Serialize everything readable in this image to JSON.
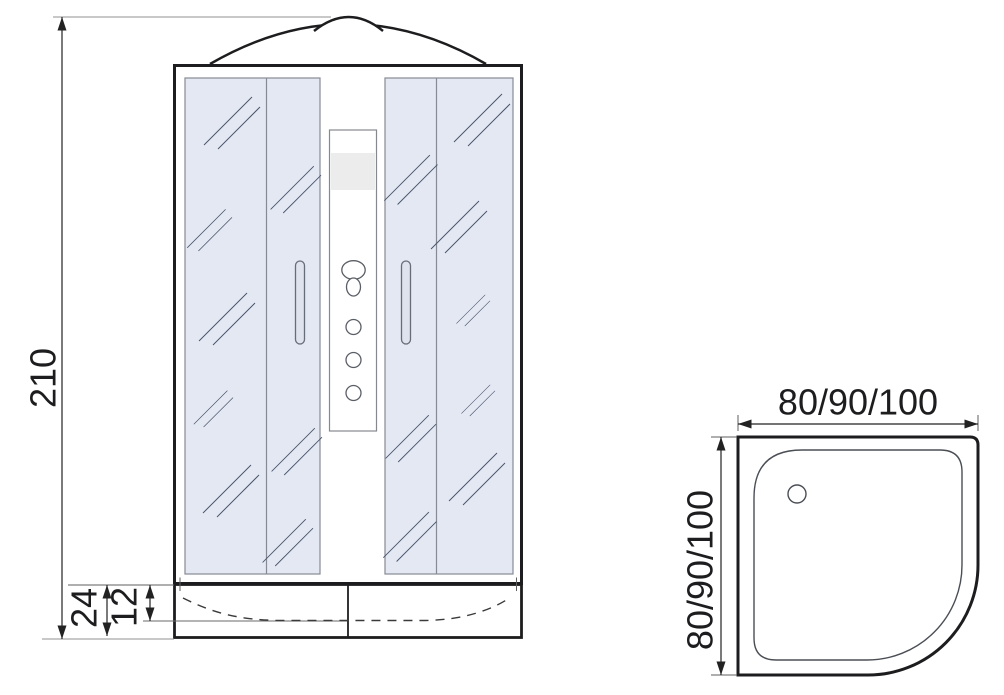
{
  "document": {
    "type": "technical-dimension-drawing",
    "subject": "shower cabin with quarter-round tray"
  },
  "front_view": {
    "labels": {
      "overall_height": "210",
      "tray_height": "24",
      "tray_basin_depth": "12"
    }
  },
  "top_view": {
    "labels": {
      "width": "80/90/100",
      "depth": "80/90/100"
    }
  },
  "colors": {
    "background": "#ffffff",
    "line": "#1d1d1f",
    "glass": "#e4e8f3",
    "glass_border": "#868a94",
    "hatch": "#49546c",
    "panel_band": "#ececec",
    "extension_line": "#909090",
    "dimension_text": "#1d1d1f"
  }
}
